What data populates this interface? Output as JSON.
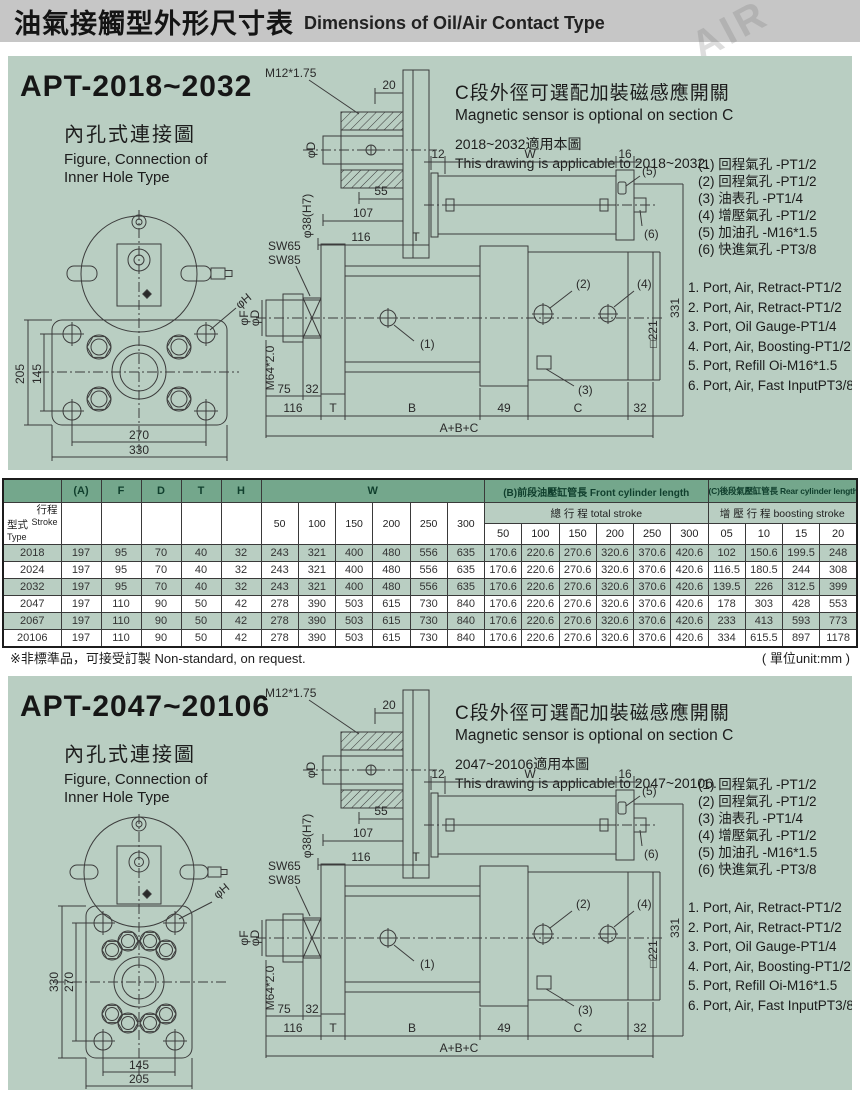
{
  "header": {
    "title_zh": "油氣接觸型外形尺寸表",
    "title_en": "Dimensions of Oil/Air Contact Type"
  },
  "watermarks": {
    "brand": "CCLAIR",
    "air": "AIR"
  },
  "shared": {
    "inner_title_zh": "內孔式連接圖",
    "inner_en1": "Figure, Connection of",
    "inner_en2": "Inner Hole Type",
    "sensor_zh": "C段外徑可選配加裝磁感應開關",
    "sensor_en": "Magnetic sensor is optional on section C",
    "ports_zh": [
      "(1) 回程氣孔 -PT1/2",
      "(2) 回程氣孔 -PT1/2",
      "(3) 油表孔 -PT1/4",
      "(4) 增壓氣孔 -PT1/2",
      "(5) 加油孔 -M16*1.5",
      "(6) 快進氣孔 -PT3/8"
    ],
    "ports_en": [
      "1. Port, Air, Retract-PT1/2",
      "2. Port, Air, Retract-PT1/2",
      "3. Port, Oil Gauge-PT1/4",
      "4. Port, Air, Boosting-PT1/2",
      "5. Port, Refill Oi-M16*1.5",
      "6. Port, Air, Fast InputPT3/8"
    ],
    "dims": {
      "m12": "M12*1.75",
      "w20": "20",
      "phiD": "φD",
      "phi38": "φ38(H7)",
      "w55": "55",
      "w107": "107",
      "w116": "116",
      "T": "T",
      "w12": "12",
      "W": "W",
      "w16": "16",
      "p1": "(1)",
      "p2": "(2)",
      "p3": "(3)",
      "p4": "(4)",
      "p5": "(5)",
      "p6": "(6)",
      "h331": "331",
      "sq221": "□221",
      "sw65": "SW65",
      "sw85": "SW85",
      "phiF": "φF",
      "m64": "M64*2.0",
      "w75": "75",
      "w32": "32",
      "B": "B",
      "w49": "49",
      "C": "C",
      "abc": "A+B+C",
      "phiH": "φH"
    }
  },
  "sections": [
    {
      "model": "APT-2018~2032",
      "applicable_zh": "2018~2032適用本圖",
      "applicable_en": "This drawing is applicable to 2018~2032.",
      "flange": {
        "v_outer": "205",
        "v_inner": "145",
        "h_inner": "270",
        "h_outer": "330"
      }
    },
    {
      "model": "APT-2047~20106",
      "applicable_zh": "2047~20106適用本圖",
      "applicable_en": "This drawing is applicable to 2047~20106.",
      "flange": {
        "v_outer": "330",
        "v_inner": "270",
        "h_inner": "145",
        "h_outer": "205"
      }
    }
  ],
  "table": {
    "corner": {
      "stroke_zh": "行程",
      "stroke_en": "Stroke",
      "type_zh": "型式",
      "type_en": "Type"
    },
    "simple_cols": [
      "(A)",
      "F",
      "D",
      "T",
      "H"
    ],
    "w_label": "W",
    "b_group": "(B)前段油壓缸管長 Front cylinder length",
    "c_group": "(C)後段氣壓缸管長 Rear cylinder length",
    "total_stroke": "總 行 程 total stroke",
    "boost_stroke": "增 壓 行 程 boosting stroke",
    "w_cols": [
      "50",
      "100",
      "150",
      "200",
      "250",
      "300"
    ],
    "b_cols": [
      "50",
      "100",
      "150",
      "200",
      "250",
      "300"
    ],
    "c_cols": [
      "05",
      "10",
      "15",
      "20"
    ],
    "rows": [
      {
        "type": "2018",
        "values": [
          "197",
          "95",
          "70",
          "40",
          "32",
          "243",
          "321",
          "400",
          "480",
          "556",
          "635",
          "170.6",
          "220.6",
          "270.6",
          "320.6",
          "370.6",
          "420.6",
          "102",
          "150.6",
          "199.5",
          "248"
        ]
      },
      {
        "type": "2024",
        "values": [
          "197",
          "95",
          "70",
          "40",
          "32",
          "243",
          "321",
          "400",
          "480",
          "556",
          "635",
          "170.6",
          "220.6",
          "270.6",
          "320.6",
          "370.6",
          "420.6",
          "116.5",
          "180.5",
          "244",
          "308"
        ]
      },
      {
        "type": "2032",
        "values": [
          "197",
          "95",
          "70",
          "40",
          "32",
          "243",
          "321",
          "400",
          "480",
          "556",
          "635",
          "170.6",
          "220.6",
          "270.6",
          "320.6",
          "370.6",
          "420.6",
          "139.5",
          "226",
          "312.5",
          "399"
        ]
      },
      {
        "type": "2047",
        "values": [
          "197",
          "110",
          "90",
          "50",
          "42",
          "278",
          "390",
          "503",
          "615",
          "730",
          "840",
          "170.6",
          "220.6",
          "270.6",
          "320.6",
          "370.6",
          "420.6",
          "178",
          "303",
          "428",
          "553"
        ]
      },
      {
        "type": "2067",
        "values": [
          "197",
          "110",
          "90",
          "50",
          "42",
          "278",
          "390",
          "503",
          "615",
          "730",
          "840",
          "170.6",
          "220.6",
          "270.6",
          "320.6",
          "370.6",
          "420.6",
          "233",
          "413",
          "593",
          "773"
        ]
      },
      {
        "type": "20106",
        "values": [
          "197",
          "110",
          "90",
          "50",
          "42",
          "278",
          "390",
          "503",
          "615",
          "730",
          "840",
          "170.6",
          "220.6",
          "270.6",
          "320.6",
          "370.6",
          "420.6",
          "334",
          "615.5",
          "897",
          "1178"
        ]
      }
    ]
  },
  "footer": {
    "note_zh": "※非標準品，可接受訂製",
    "note_en": "Non-standard, on request.",
    "unit": "( 單位unit:mm )"
  }
}
